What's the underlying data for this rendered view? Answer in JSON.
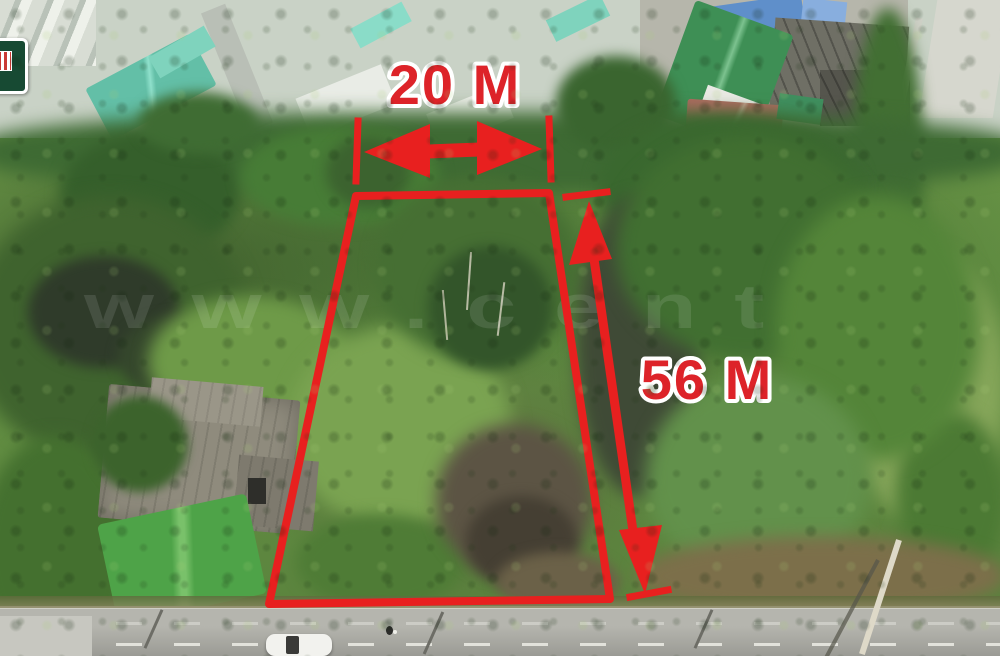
{
  "scene": {
    "description": "aerial drone photo of vacant land plot outlined for sale",
    "watermark": "www.cent",
    "palette": {
      "annotation_red": "#e8201f",
      "label_fill": "#dd2329",
      "label_outline": "#ffffff",
      "logo_green": "#174a33",
      "roof_green": "#449c5d",
      "tarp_green": "#4ea348",
      "road_gray": "#a8a8a1"
    }
  },
  "annotations": {
    "width_label": "20 M",
    "depth_label": "56 M",
    "plot_points": "356,196 549,193 610,599 269,604"
  }
}
